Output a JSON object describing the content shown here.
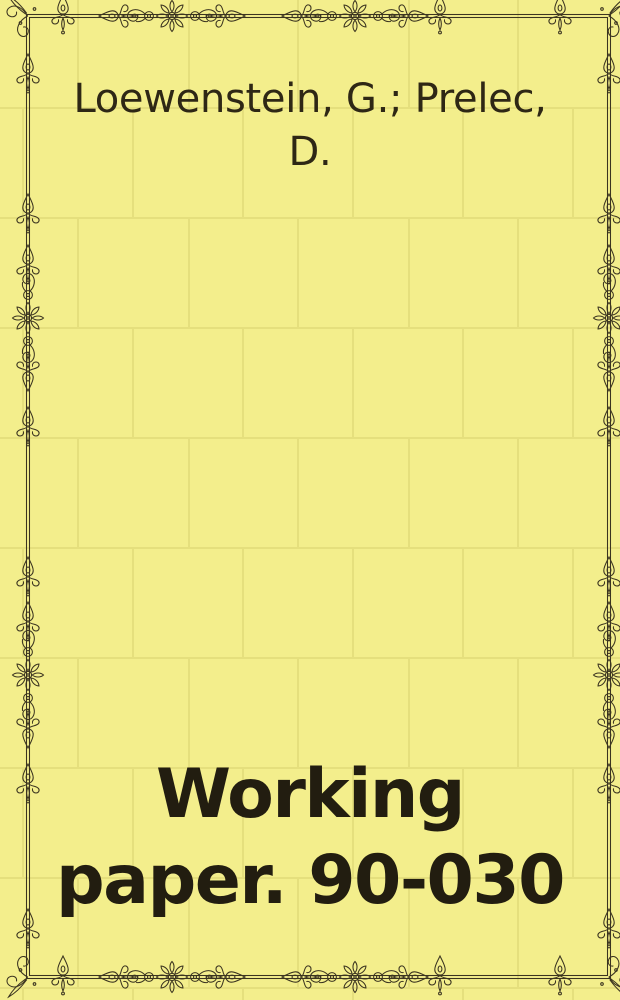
{
  "cover": {
    "authors": "Loewenstein, G.; Prelec, D.",
    "author_lines": [
      "Loewenstein, G.; Prelec,",
      "D."
    ],
    "title": "Working paper. 90-030",
    "title_lines": [
      "Working",
      "paper. 90-030"
    ]
  },
  "colors": {
    "background": "#f3ee8c",
    "tile_line": "#e5df7d",
    "border_ink": "#3b3420",
    "author_ink": "#2e2715",
    "title_ink": "#221d10"
  }
}
